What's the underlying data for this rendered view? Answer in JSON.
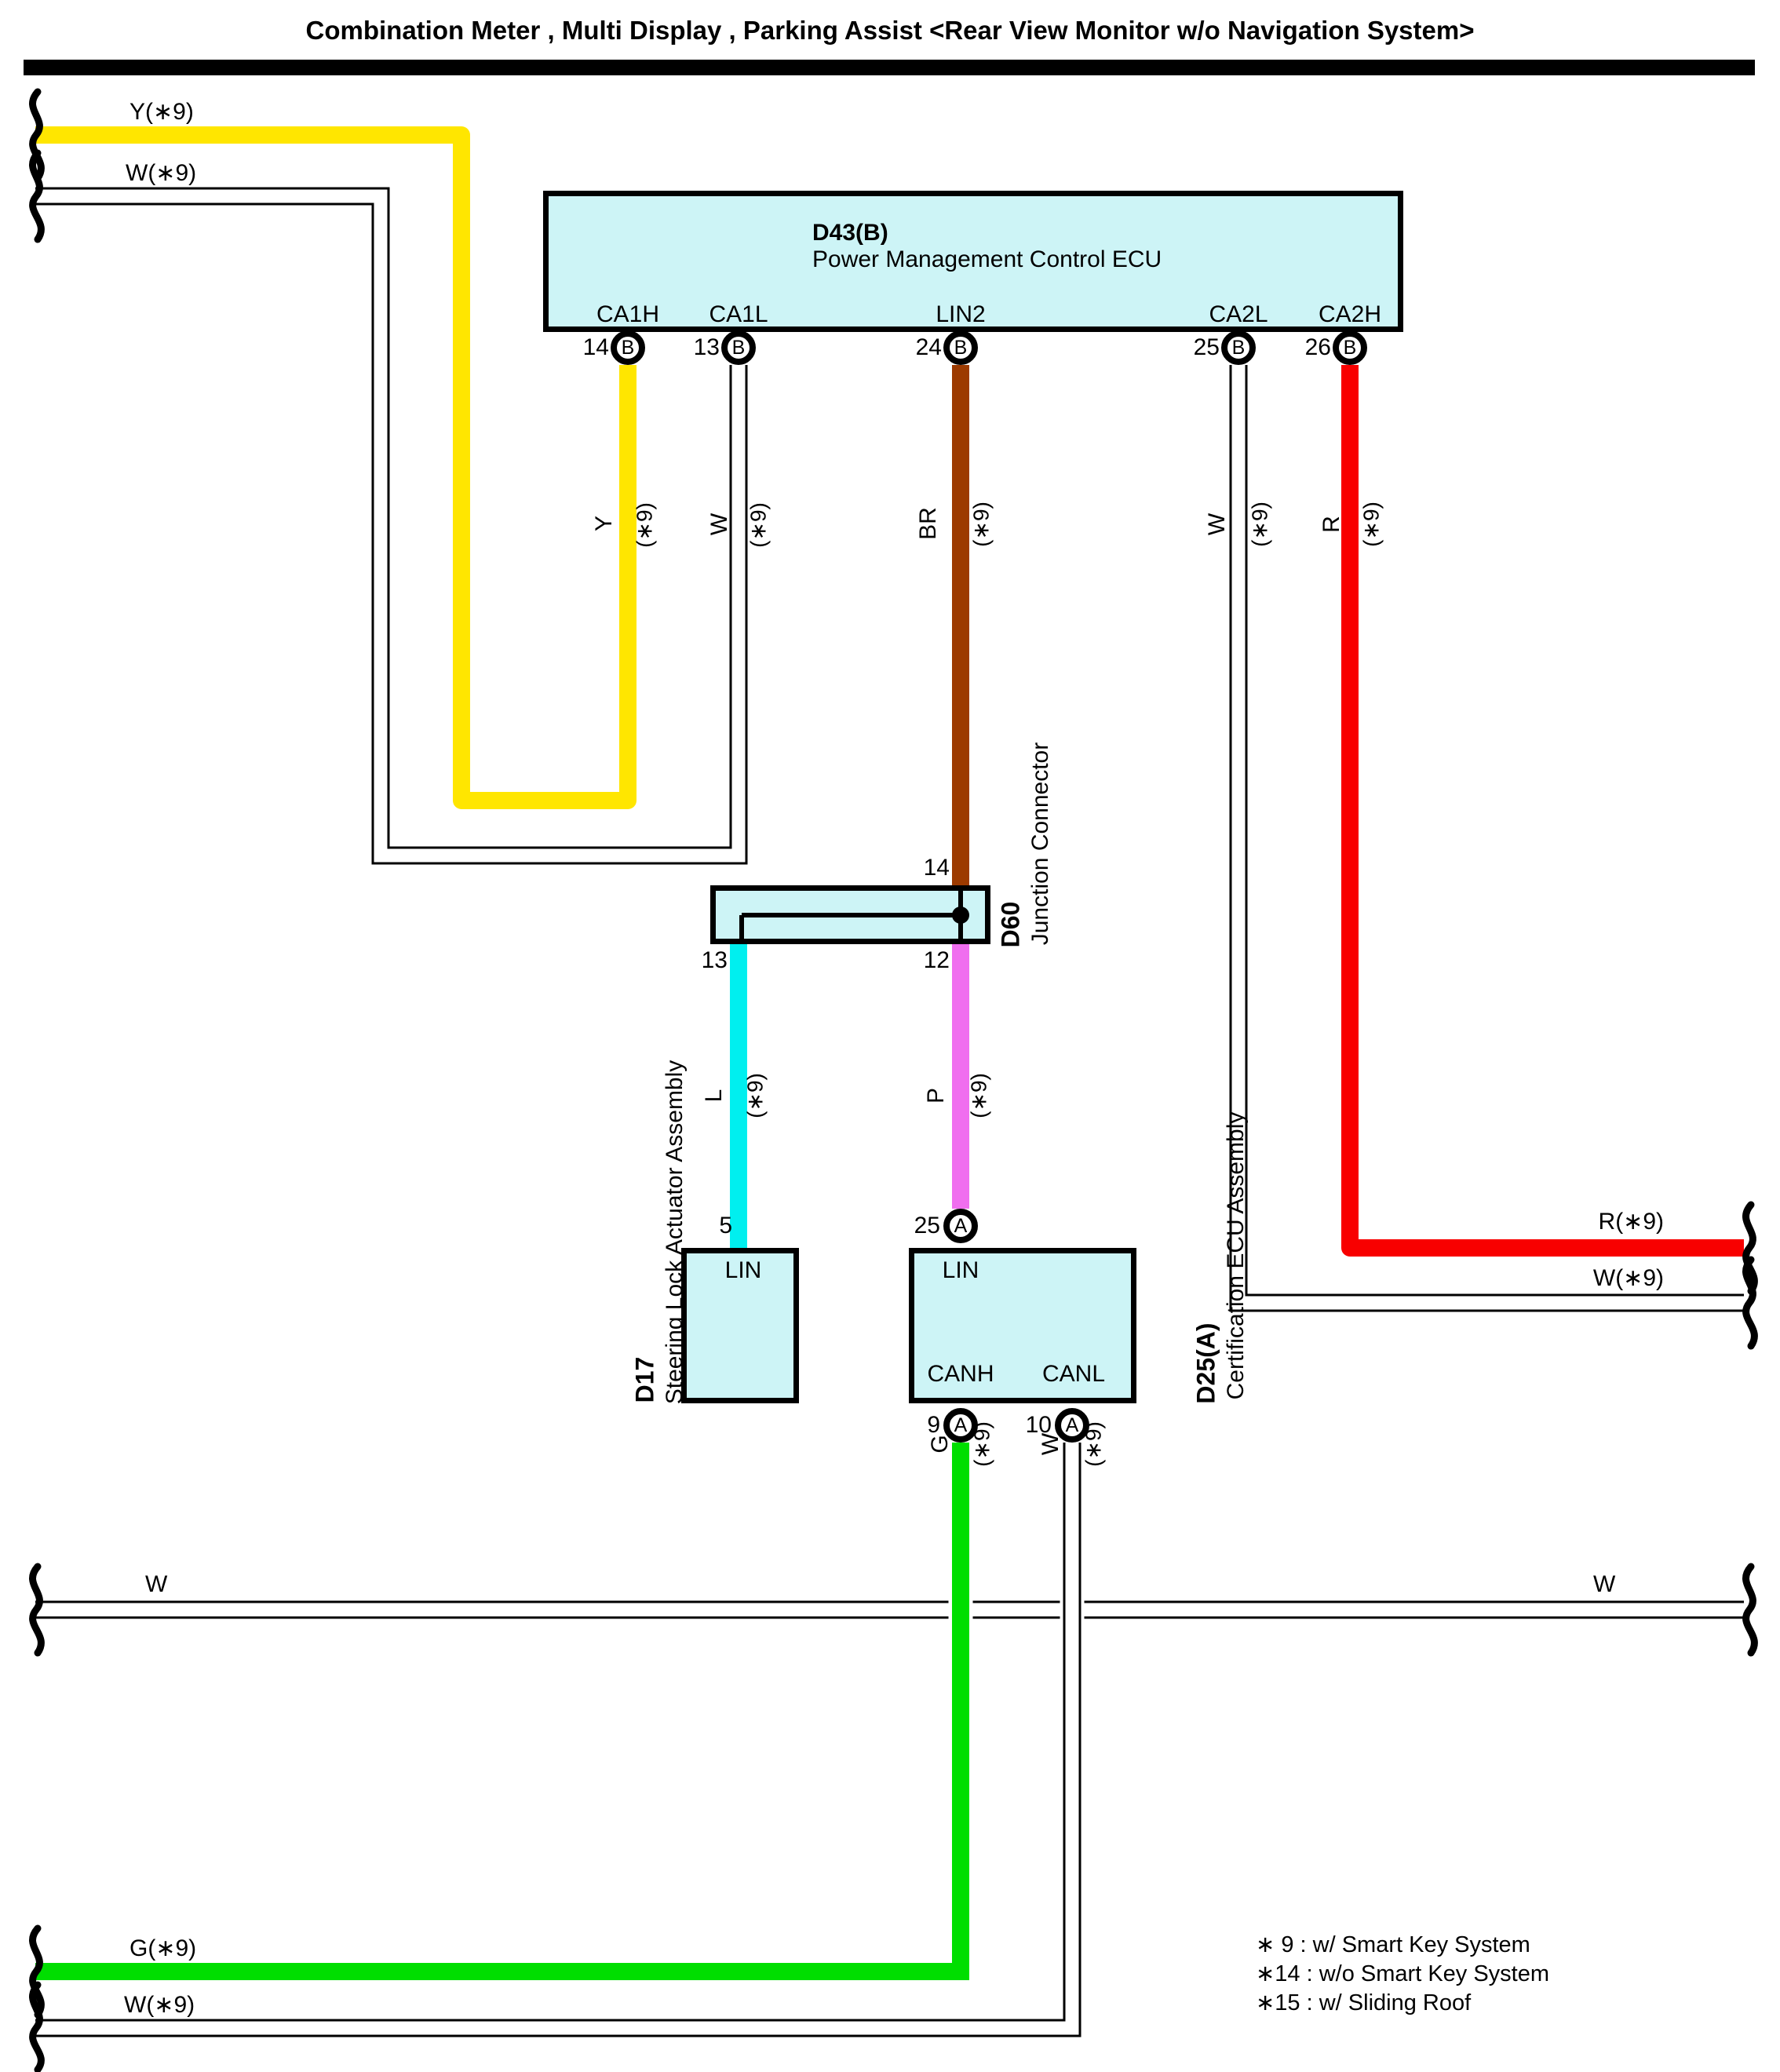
{
  "title": "Combination Meter , Multi Display , Parking Assist <Rear View Monitor w/o Navigation System>",
  "colors": {
    "box_fill": "#CDF4F6",
    "yellow": "#FFE600",
    "red": "#F80000",
    "green": "#00DE00",
    "cyan": "#00EFEF",
    "pink": "#F06EEF",
    "brown": "#9C3A00",
    "white_wire": "#FFFFFF",
    "black": "#000000"
  },
  "d43": {
    "code": "D43(B)",
    "name": "Power Management Control ECU",
    "pins": [
      {
        "name": "CA1H",
        "num": "14",
        "conn": "B"
      },
      {
        "name": "CA1L",
        "num": "13",
        "conn": "B"
      },
      {
        "name": "LIN2",
        "num": "24",
        "conn": "B"
      },
      {
        "name": "CA2L",
        "num": "25",
        "conn": "B"
      },
      {
        "name": "CA2H",
        "num": "26",
        "conn": "B"
      }
    ]
  },
  "d60": {
    "code": "D60",
    "name": "Junction Connector",
    "pin_top": "14",
    "pin_bottom_left": "13",
    "pin_bottom_right": "12"
  },
  "d17": {
    "code": "D17",
    "name": "Steering Lock Actuator Assembly",
    "pin_num": "5",
    "pin_name": "LIN"
  },
  "d25": {
    "code": "D25(A)",
    "name": "Certification ECU Assembly",
    "pin_lin": {
      "num": "25",
      "name": "LIN",
      "conn": "A"
    },
    "pin_canh": {
      "num": "9",
      "name": "CANH",
      "conn": "A"
    },
    "pin_canl": {
      "num": "10",
      "name": "CANL",
      "conn": "A"
    }
  },
  "wire_labels": {
    "top_y": "Y(∗9)",
    "top_w": "W(∗9)",
    "v_y": {
      "c": "Y",
      "s": "(∗9)"
    },
    "v_w1": {
      "c": "W",
      "s": "(∗9)"
    },
    "v_br": {
      "c": "BR",
      "s": "(∗9)"
    },
    "v_w2": {
      "c": "W",
      "s": "(∗9)"
    },
    "v_r": {
      "c": "R",
      "s": "(∗9)"
    },
    "v_l": {
      "c": "L",
      "s": "(∗9)"
    },
    "v_p": {
      "c": "P",
      "s": "(∗9)"
    },
    "v_g": {
      "c": "G",
      "s": "(∗9)"
    },
    "v_w3": {
      "c": "W",
      "s": "(∗9)"
    },
    "right_r": "R(∗9)",
    "right_w": "W(∗9)",
    "long_w_left": "W",
    "long_w_right": "W",
    "bottom_g": "G(∗9)",
    "bottom_w": "W(∗9)"
  },
  "notes": {
    "n9": "∗ 9 : w/ Smart Key System",
    "n14": "∗14 : w/o Smart Key System",
    "n15": "∗15 : w/ Sliding Roof"
  }
}
